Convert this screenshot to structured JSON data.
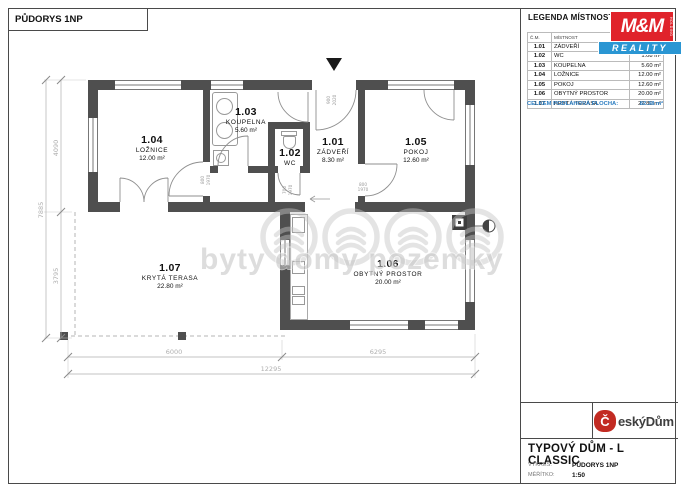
{
  "sheet": {
    "drawing_title": "PŮDORYS 1NP",
    "legend": {
      "title": "LEGENDA MÍSTNOSTÍ",
      "header": {
        "cm": "Č.M.",
        "room": "MÍSTNOST",
        "area": ""
      },
      "rows": [
        {
          "cm": "1.01",
          "room": "ZÁDVEŘÍ",
          "area": ""
        },
        {
          "cm": "1.02",
          "room": "WC",
          "area": "1.08 m²"
        },
        {
          "cm": "1.03",
          "room": "KOUPELNA",
          "area": "5.60 m²"
        },
        {
          "cm": "1.04",
          "room": "LOŽNICE",
          "area": "12.00 m²"
        },
        {
          "cm": "1.05",
          "room": "POKOJ",
          "area": "12.60 m²"
        },
        {
          "cm": "1.06",
          "room": "OBYTNÝ PROSTOR",
          "area": "20.00 m²"
        },
        {
          "cm": "1.07",
          "room": "KRYTÁ TERASA",
          "area": "22.80 m²"
        }
      ],
      "total_label": "CELKEM PODLAHOVÁ PLOCHA:",
      "total_value": "82.38 m²"
    },
    "title_block": {
      "title": "TYPOVÝ DŮM - L CLASSIC",
      "rows": [
        {
          "label": "VÝKRES:",
          "value": "PŮDORYS 1NP"
        },
        {
          "label": "MĚŘÍTKO:",
          "value": "1:50"
        }
      ]
    }
  },
  "logos": {
    "mm_reality": {
      "monogram": "M&M",
      "side_text": "HOLDING",
      "banner": "REALITY"
    },
    "cesky_dum": {
      "initial": "Č",
      "rest": "eskýDům"
    }
  },
  "plan": {
    "rooms": {
      "zadveri": {
        "id": "1.01",
        "name": "ZÁDVEŘÍ",
        "area": "8.30 m²"
      },
      "wc": {
        "id": "1.02",
        "name": "WC"
      },
      "koupelna": {
        "id": "1.03",
        "name": "KOUPELNA",
        "area": "5.60 m²"
      },
      "loznice": {
        "id": "1.04",
        "name": "LOŽNICE",
        "area": "12.00 m²"
      },
      "pokoj": {
        "id": "1.05",
        "name": "POKOJ",
        "area": "12.60 m²"
      },
      "obytny": {
        "id": "1.06",
        "name": "OBYTNÝ PROSTOR",
        "area": "20.00 m²"
      },
      "terasa": {
        "id": "1.07",
        "name": "KRYTÁ TERASA",
        "area": "22.80 m²"
      }
    },
    "dims": {
      "total_width": "12295",
      "terrace_width": "6000",
      "house_width": "6295",
      "total_height": "7885",
      "top_height": "4090",
      "bottom_height": "3795"
    },
    "door_labels": [
      {
        "w": "900",
        "h": "2020"
      },
      {
        "w": "800",
        "h": "1970"
      },
      {
        "w": "800",
        "h": "1970"
      },
      {
        "w": "700",
        "h": "1970"
      }
    ],
    "watermark": "byty domy pozemky"
  },
  "colors": {
    "wall": "#4f4f4f",
    "mm_red": "#e0232b",
    "mm_blue": "#2a96d3",
    "cesky_dum_red": "#c22b22",
    "legend_total_blue": "#2a7cc0",
    "watermark_gray": "#c8c8c8"
  }
}
